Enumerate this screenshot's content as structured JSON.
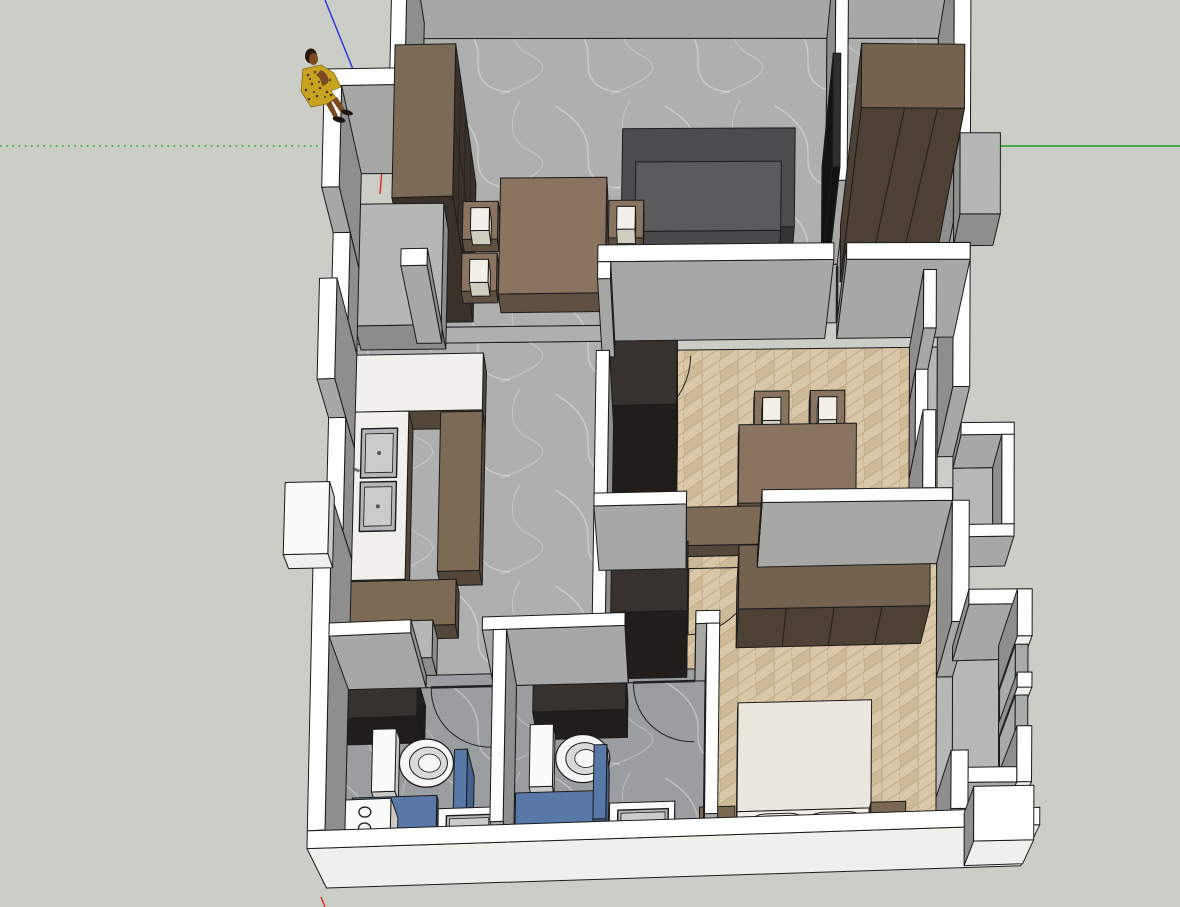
{
  "app": {
    "name": "3d-floor-plan-viewport",
    "view": "top-perspective"
  },
  "colors": {
    "background": "#cbcec7",
    "outline": "#1b1b1b",
    "wall_top": "#ffffff",
    "wall_face": "#a7a7a5",
    "wall_side": "#8e8e8c",
    "wall_face_light": "#efefec",
    "floor_marble": "#aeb0af",
    "floor_marble_dim": "#b6b8b5",
    "floor_bath": "#9b9ea0",
    "herringbone_a": "#dac7a7",
    "herringbone_b": "#cfba97",
    "herringbone_line": "#c2ab85",
    "counter_top": "#f1f0ec",
    "cabinet_top": "#7d6a55",
    "cabinet_face": "#53473a",
    "wood_top": "#8a7460",
    "wood_face": "#5f5142",
    "wardrobe_top": "#73624d",
    "wardrobe_face": "#4d4136",
    "seam": "#2a241e",
    "shelf_top": "#7b6a56",
    "shelf_face": "#3a322a",
    "dark_top": "#37322d",
    "dark_face": "#201d1a",
    "sofa_top": "#4a4d4e",
    "sofa_face": "#323435",
    "sofa_seat": "#595c5d",
    "sofa_seat_face": "#47494a",
    "coffee_top": "#4a4d4f",
    "coffee_side": "#2e3031",
    "bed_top": "#eae7df",
    "bed_face": "#cfccc0",
    "pillow": "#f3f0e9",
    "nightstand_top": "#7b6852",
    "nightstand_face": "#564838",
    "gray_top": "#b5b7b4",
    "gray_face": "#8b8d8a",
    "blue_top": "#5878a8",
    "blue_face": "#44608c",
    "white_top": "#fbfbf9",
    "white_side": "#c9c9c5",
    "steel": "#b3b6b5",
    "steel_inner": "#c9cccb",
    "glass": "#a7abaa",
    "tv_top": "#2e2f30",
    "tv_face": "#121314",
    "mat": "#86755f",
    "toilet": "#f6f6f4",
    "toilet_seat": "#d9d9d6",
    "vein": "#ffffff",
    "axis_red": "#e02b1d",
    "axis_green": "#1ea31e",
    "axis_blue": "#2433dd",
    "figure_skin": "#7a4a22",
    "figure_hair": "#241611",
    "figure_dress": "#c9a31f",
    "figure_spot": "#4a3a11",
    "figure_spot_blue": "#2c3b63",
    "figure_shoe": "#1c1410"
  },
  "scene": {
    "rooms": [
      "living-dining-room",
      "walk-in-closet",
      "kitchen",
      "hallway",
      "study-room",
      "master-bedroom",
      "bathroom-1",
      "bathroom-2",
      "balcony-niche",
      "bay-window"
    ],
    "furniture": [
      "bookshelf",
      "dining-table",
      "dining-chairs",
      "sofa",
      "coffee-table",
      "tv-panel",
      "closet-wardrobe",
      "kitchen-counter",
      "double-sink",
      "study-desk",
      "desk-chairs",
      "study-cabinet",
      "credenza",
      "bedroom-wardrobe",
      "bed",
      "pillows",
      "nightstands",
      "toilets",
      "shower-trays",
      "bathroom-sinks",
      "appliance-with-burners"
    ]
  },
  "axes": {
    "origin_screen": [
      384,
      146
    ],
    "red": "solid-down-dotted-up",
    "green": "solid-right-dotted-left",
    "blue": "solid-up"
  },
  "figure": {
    "type": "scale-figure-person",
    "dress": "yellow-patterned"
  }
}
